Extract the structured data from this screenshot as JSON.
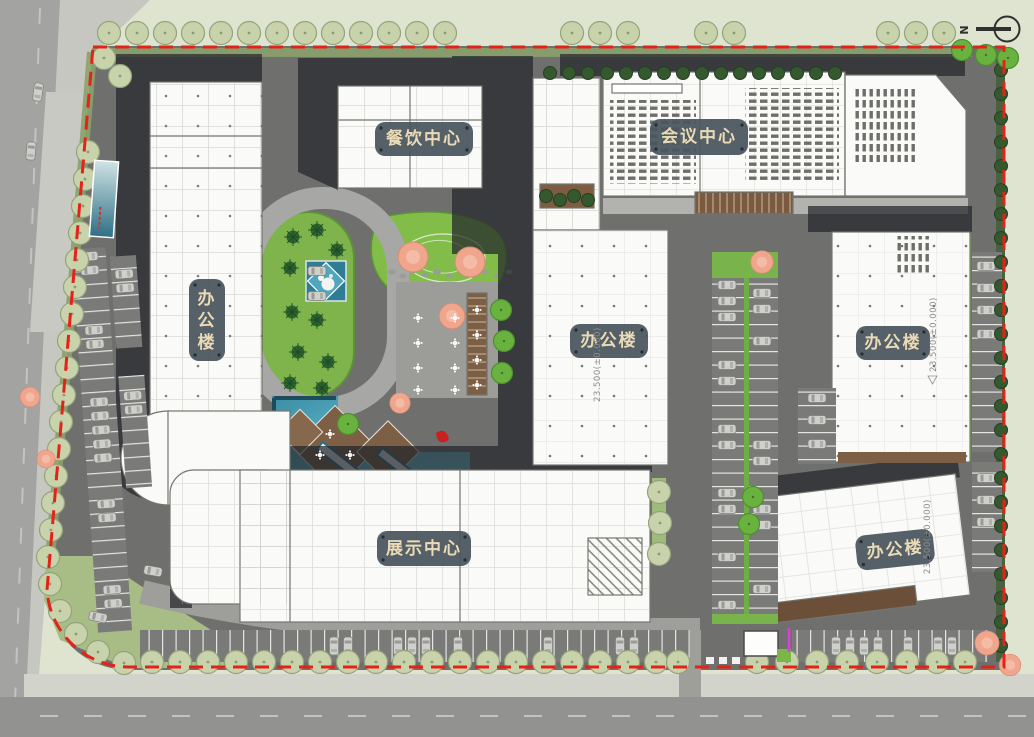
{
  "north": {
    "label": "N"
  },
  "labels": {
    "dining": "餐饮中心",
    "conference": "会议中心",
    "office_west": "办公楼",
    "office_west_chars": [
      "办",
      "公",
      "楼"
    ],
    "office_center": "办公楼",
    "office_east": "办公楼",
    "exhibition": "展示中心",
    "office_southeast": "办公楼"
  },
  "annotations": {
    "elevation_east": "23.500(±0.000)",
    "elevation_center": "23.500(±0.000)",
    "elevation_southeast": "23.500(±0.000)"
  },
  "colors": {
    "site_boundary": "#e3231a",
    "label_background": "#4b565f",
    "label_text": "#eadbb6",
    "asphalt": "#6f6f6d",
    "building_fill": "#fafaf8",
    "shadow": "#23262b",
    "grass_bright": "#7fb74d",
    "grass_pale": "#c8d3ab",
    "water": "#5cb8cb",
    "deck_brown": "#7d5f45",
    "outside_ground": "#dfe4d1",
    "road_outer": "#a3a3a1"
  }
}
